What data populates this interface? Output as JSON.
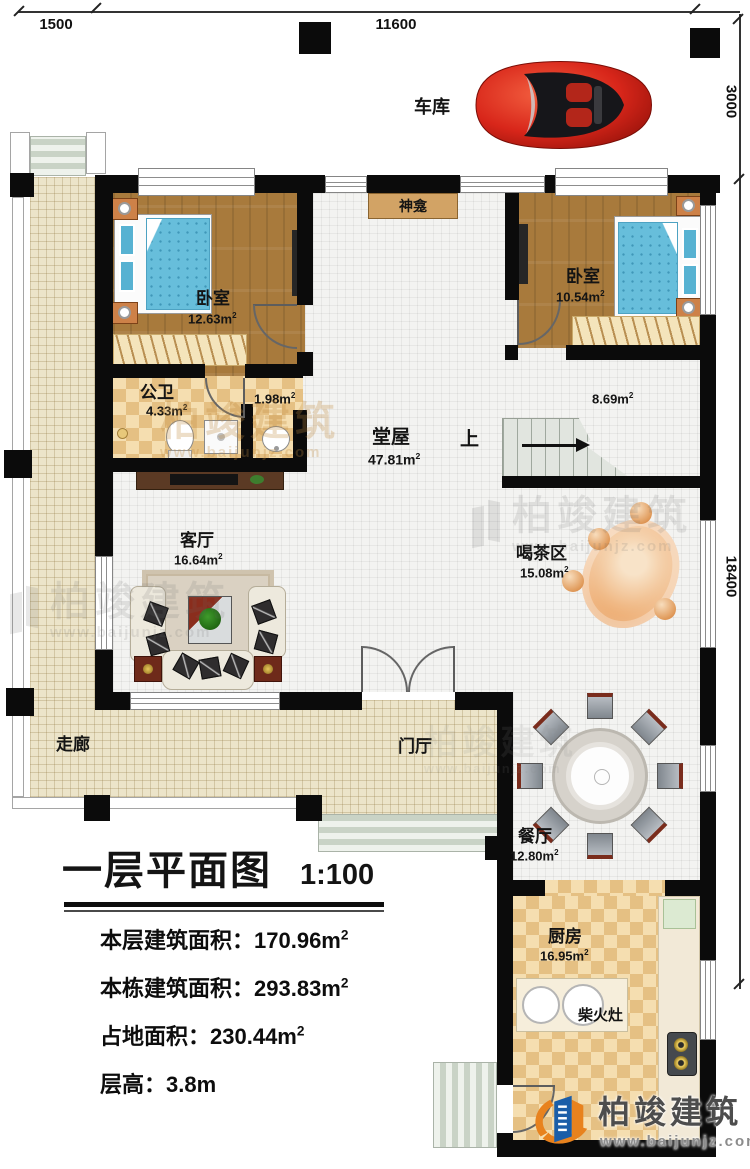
{
  "dimensions": {
    "top_left": "1500",
    "top_main": "11600",
    "right_upper": "3000",
    "right_lower": "18400"
  },
  "labels": {
    "garage": "车库",
    "shrine": "神龛",
    "corridor": "走廊",
    "foyer": "门厅",
    "stairs_up": "上",
    "wood_stove": "柴火灶"
  },
  "rooms": {
    "bedroom_left": {
      "name": "卧室",
      "area": "12.63m",
      "sup": "2"
    },
    "bedroom_right": {
      "name": "卧室",
      "area": "10.54m",
      "sup": "2"
    },
    "bathroom": {
      "name": "公卫",
      "area": "4.33m",
      "sup": "2"
    },
    "lavatory": {
      "area": "1.98m",
      "sup": "2"
    },
    "hall": {
      "name": "堂屋",
      "area": "47.81m",
      "sup": "2"
    },
    "stair_hall": {
      "area": "8.69m",
      "sup": "2"
    },
    "living": {
      "name": "客厅",
      "area": "16.64m",
      "sup": "2"
    },
    "tea": {
      "name": "喝茶区",
      "area": "15.08m",
      "sup": "2"
    },
    "dining": {
      "name": "餐厅",
      "area": "12.80m",
      "sup": "2"
    },
    "kitchen": {
      "name": "厨房",
      "area": "16.95m",
      "sup": "2"
    }
  },
  "title_block": {
    "title": "一层平面图",
    "scale": "1:100",
    "rows": [
      {
        "label": "本层建筑面积：",
        "value": "170.96m",
        "sup": "2"
      },
      {
        "label": "本栋建筑面积：",
        "value": "293.83m",
        "sup": "2"
      },
      {
        "label": "占地面积：",
        "value": "230.44m",
        "sup": "2"
      },
      {
        "label": "层高：",
        "value": "3.8m",
        "sup": ""
      }
    ]
  },
  "branding": {
    "company": "柏竣建筑",
    "website": "www.baijunjz.com"
  },
  "palette": {
    "wall": "#0b0b0b",
    "wood_floor": "#a87a3c",
    "corridor_tile": "#ece4c9",
    "checker_dark": "#e5c083",
    "checker_light": "#f5deb0",
    "bed_blue": "#67bedb",
    "car_red": "#d8261a",
    "logo_blue": "#1b5ea8",
    "logo_orange": "#e8821e"
  }
}
